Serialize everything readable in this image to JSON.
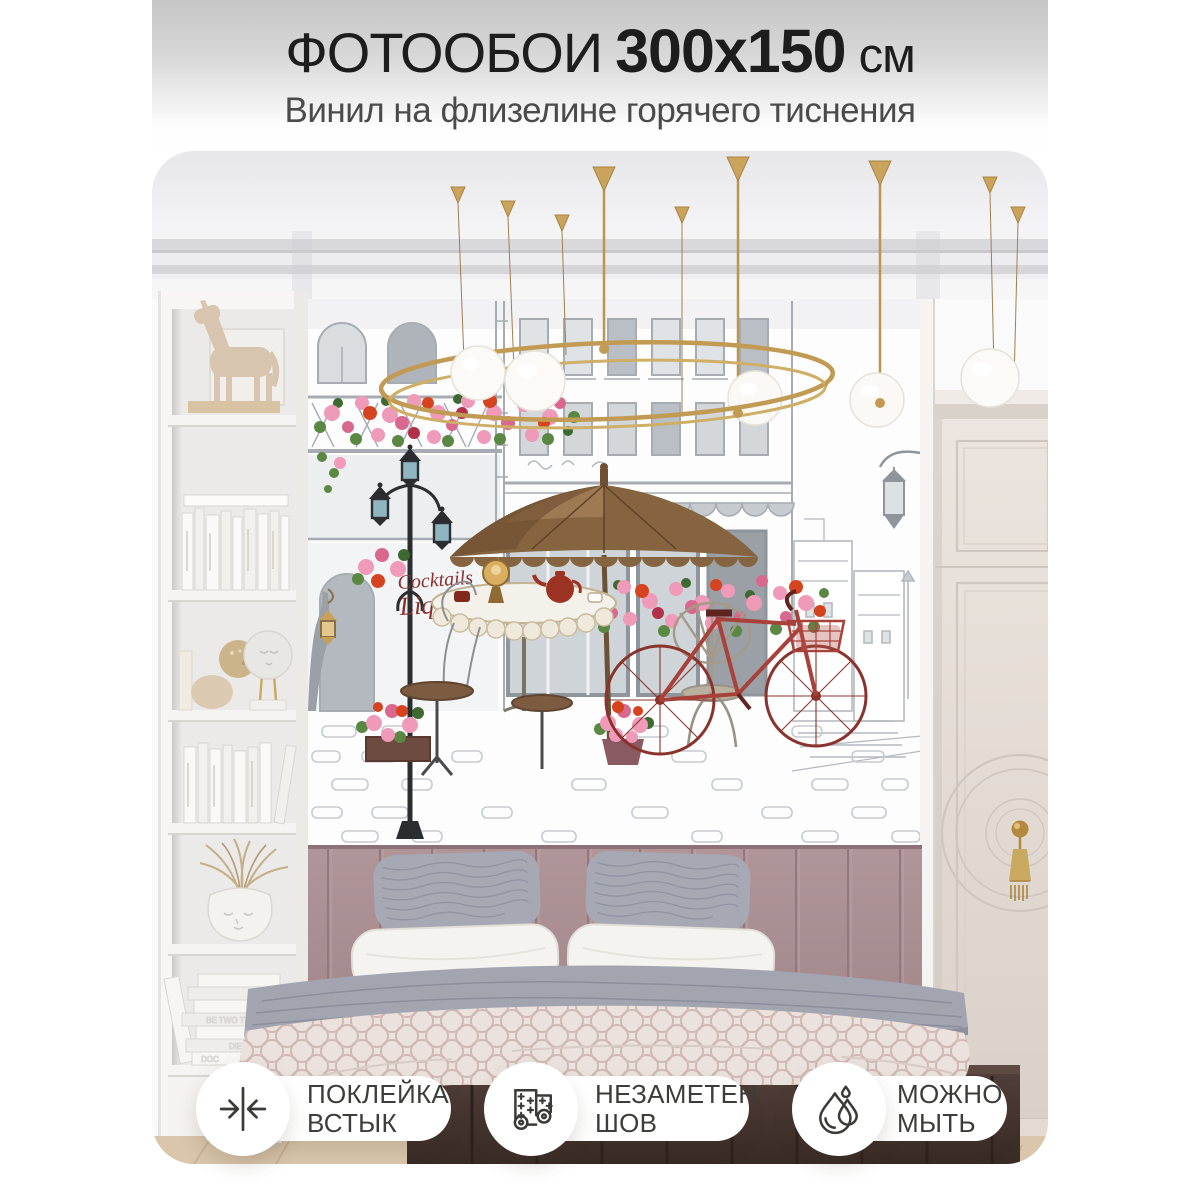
{
  "header": {
    "title_prefix": "ФОТООБОИ",
    "title_size": "300х150",
    "title_unit": "см",
    "subtitle": "Винил на флизелине горячего тиснения"
  },
  "photo": {
    "mural_sign_line1": "Cocktails",
    "mural_sign_line2": "Liqueurs"
  },
  "badges": [
    {
      "id": "butt-joint",
      "icon": "seam-arrows-icon",
      "lines": [
        "ПОКЛЕЙКА",
        "ВСТЫК"
      ]
    },
    {
      "id": "invisible-seam",
      "icon": "wallpaper-rolls-icon",
      "lines": [
        "НЕЗАМЕТЕН",
        "ШОВ"
      ]
    },
    {
      "id": "washable",
      "icon": "water-drop-icon",
      "lines": [
        "МОЖНО",
        "МЫТЬ"
      ]
    }
  ],
  "colors": {
    "header_gradient_top": "#c6c6c6",
    "title_text": "#1d1d1d",
    "subtitle_text": "#4b4b4b",
    "badge_background": "#ffffff",
    "badge_text": "#3c3c3a",
    "badge_icon": "#3a3a38",
    "chandelier_gold": "#c19b53",
    "mural_sketch_gray": "#a6acb2",
    "mural_sign_red": "#8c2f2f",
    "flower_pink": "#ee9ab8",
    "flower_red": "#d6431f",
    "umbrella_brown": "#86643f",
    "bicycle_red": "#a8413a",
    "headboard_mauve": "#ab9094",
    "bench_brown": "#4a3833",
    "floor_wood": "#d9c6ab"
  }
}
